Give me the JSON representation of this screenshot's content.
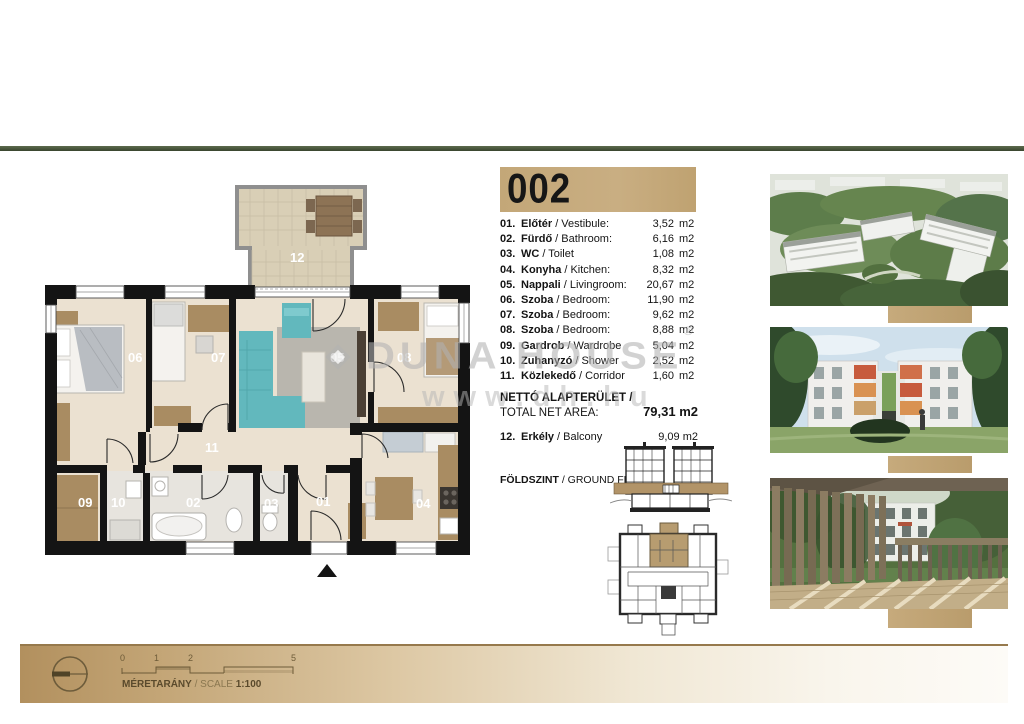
{
  "header": {
    "unit_number": "002"
  },
  "legend": {
    "rows": [
      {
        "num": "01.",
        "name_hu": "Előtér",
        "name_en": "/ Vestibule:",
        "value": "3,52",
        "unit": "m2"
      },
      {
        "num": "02.",
        "name_hu": "Fürdő",
        "name_en": "/ Bathroom:",
        "value": "6,16",
        "unit": "m2"
      },
      {
        "num": "03.",
        "name_hu": "WC",
        "name_en": "/ Toilet",
        "value": "1,08",
        "unit": "m2"
      },
      {
        "num": "04.",
        "name_hu": "Konyha",
        "name_en": "/ Kitchen:",
        "value": "8,32",
        "unit": "m2"
      },
      {
        "num": "05.",
        "name_hu": "Nappali",
        "name_en": "/ Livingroom:",
        "value": "20,67",
        "unit": "m2"
      },
      {
        "num": "06.",
        "name_hu": "Szoba",
        "name_en": "/ Bedroom:",
        "value": "11,90",
        "unit": "m2"
      },
      {
        "num": "07.",
        "name_hu": "Szoba",
        "name_en": "/ Bedroom:",
        "value": "9,62",
        "unit": "m2"
      },
      {
        "num": "08.",
        "name_hu": "Szoba",
        "name_en": "/ Bedroom:",
        "value": "8,88",
        "unit": "m2"
      },
      {
        "num": "09.",
        "name_hu": "Gardrob",
        "name_en": "/ Wardrobe",
        "value": "5,04",
        "unit": "m2"
      },
      {
        "num": "10.",
        "name_hu": "Zuhanyzó",
        "name_en": "/ Shower",
        "value": "2,52",
        "unit": "m2"
      },
      {
        "num": "11.",
        "name_hu": "Közlekedő",
        "name_en": "/ Corridor",
        "value": "1,60",
        "unit": "m2"
      }
    ],
    "total": {
      "label_hu": "NETTÓ ALAPTERÜLET /",
      "label_en": "TOTAL NET AREA:",
      "value": "79,31 m2"
    },
    "balcony": {
      "num": "12.",
      "name_hu": "Erkély",
      "name_en": "/ Balcony",
      "value": "9,09 m2"
    },
    "floor": {
      "hu": "FÖLDSZINT",
      "en": "/ GROUND FLOOR"
    }
  },
  "plan": {
    "labels": {
      "r01": "01",
      "r02": "02",
      "r03": "03",
      "r04": "04",
      "r05": "05",
      "r06": "06",
      "r07": "07",
      "r08": "08",
      "r09": "09",
      "r10": "10",
      "r11": "11",
      "r12": "12"
    }
  },
  "watermark": {
    "brand": "DUNA HOUSE",
    "reg": "®",
    "url": "www.dh.hu"
  },
  "scalebar": {
    "ticks": [
      "0",
      "1",
      "2",
      "5"
    ],
    "label_hu": "MÉRETARÁNY",
    "label_en": "/ SCALE",
    "ratio": "1:100"
  },
  "colors": {
    "accent_tan": "#c2a67b",
    "rule_olive": "#44503a",
    "wall_black": "#141414"
  }
}
